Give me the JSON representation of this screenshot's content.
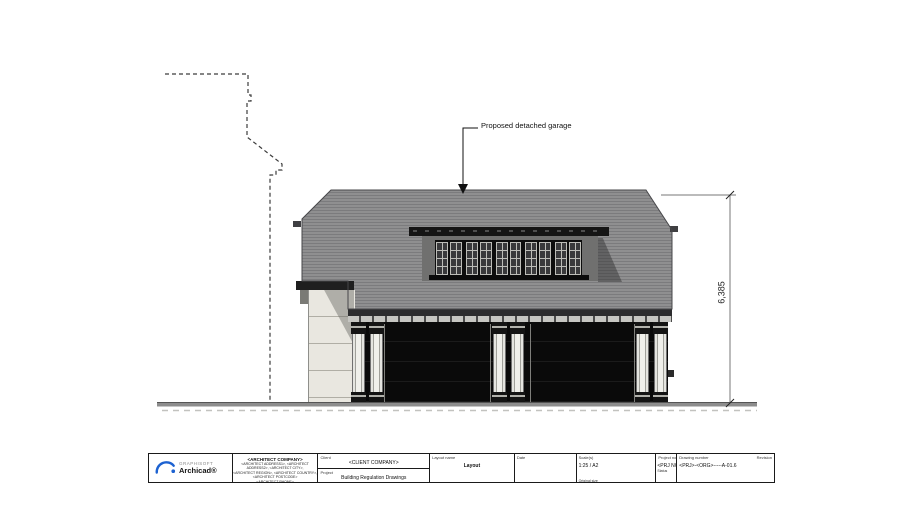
{
  "drawing": {
    "annotation_label": "Proposed detached garage",
    "dimension_value": "6,385"
  },
  "title_block": {
    "logo": {
      "brand": "GRAPHISOFT",
      "product": "Archicad®"
    },
    "architect": {
      "company": "<ARCHITECT COMPANY>",
      "address_line1": "<ARCHITECT ADDRESS1>, <ARCHITECT ADDRESS2>, <ARCHITECT CITY>,",
      "address_line2": "<ARCHITECT REGION>, <ARCHITECT COUNTRY>, <ARCHITECT POSTCODE>",
      "contact_line1": "<ARCHITECT PHONE>",
      "contact_line2": "<ARCHITECT EMAIL>"
    },
    "client": {
      "label": "Client",
      "value": "<CLIENT COMPANY>"
    },
    "project": {
      "label": "Project",
      "value": "Building Regulation Drawings"
    },
    "layout": {
      "label": "Layout name",
      "value": "Layout"
    },
    "date": {
      "label": "Date",
      "value": ""
    },
    "scale": {
      "label": "Scale(s)",
      "value": "1:25 / A2",
      "sub_label": "Original size"
    },
    "project_no": {
      "label": "Project no",
      "value": "<PRJ NO>",
      "sub_label": "Status"
    },
    "drawing_no": {
      "label": "Drawing number",
      "value": "<PRJ>-<ORG>-----A-01.6"
    },
    "revision": {
      "label": "Revision",
      "value": ""
    }
  },
  "colors": {
    "roof_gray": "#88888a",
    "door_black": "#0a0a0a",
    "column_shaft": "#ebebe6",
    "side_wall": "#e9e7e0",
    "ground_gray": "#8d8d8d",
    "logo_blue": "#1d62d1"
  }
}
